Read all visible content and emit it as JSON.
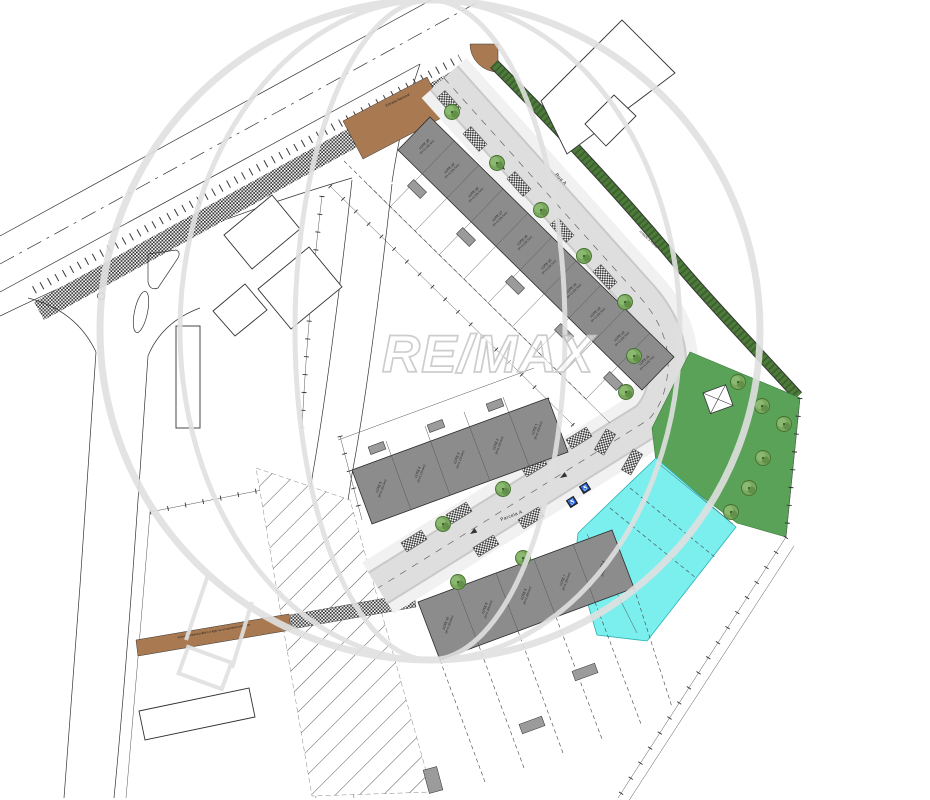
{
  "watermark": {
    "text": "RE/MAX"
  },
  "streets": {
    "main_road_label": "Estrada Nacional",
    "rua_label": "Rua A",
    "parcela_label": "Parcela A"
  },
  "annotations": {
    "hedge_label": "vedação a manter",
    "path_label": "acesso pedonal público a ligar ao arruamento existente"
  },
  "icons": {
    "tree_icon": "deciduous-tree",
    "wheelchair_glyph": "♿",
    "transformer_icon": "crossed-box"
  },
  "lots": {
    "upper": [
      {
        "name": "LOTE 20",
        "info": "2P+S 238.4m2"
      },
      {
        "name": "LOTE 19",
        "info": "2P+S 206.5m2"
      },
      {
        "name": "LOTE 18",
        "info": "2P+S 206.5m2"
      },
      {
        "name": "LOTE 17",
        "info": "2P+S 206.5m2"
      },
      {
        "name": "LOTE 16",
        "info": "2P+S 206.5m2"
      },
      {
        "name": "LOTE 15",
        "info": "2P+S 206.5m2"
      },
      {
        "name": "LOTE 14",
        "info": "2P+S 206.5m2"
      },
      {
        "name": "LOTE 13",
        "info": "2P+S 206.5m2"
      },
      {
        "name": "LOTE 12",
        "info": "2P+S 206.5m2"
      },
      {
        "name": "LOTE 11",
        "info": "2P+S 228.7m2"
      }
    ],
    "middle": [
      {
        "name": "LOTE 5",
        "info": "2P+S 264.3m2"
      },
      {
        "name": "LOTE 4",
        "info": "2P+S 215.9m2"
      },
      {
        "name": "LOTE 3",
        "info": "2P+S 215.9m2"
      },
      {
        "name": "LOTE 2",
        "info": "2P+S 215.9m2"
      },
      {
        "name": "LOTE 1",
        "info": "2P+S 258.6m2"
      }
    ],
    "lower": [
      {
        "name": "LOTE 10",
        "info": "2P+S 403.8m2"
      },
      {
        "name": "LOTE 9",
        "info": "2P+S 296.5m2"
      },
      {
        "name": "LOTE 8",
        "info": "2P+S 296.5m2"
      },
      {
        "name": "LOTE 7",
        "info": "2P+S 296.5m2"
      },
      {
        "name": "LOTE 6",
        "info": "2P+S 303.8m2"
      }
    ]
  },
  "colors": {
    "road_asphalt": "#dedede",
    "building": "#8c8c8c",
    "annex": "#9b9b9b",
    "lawn": "#59a257",
    "pool": "#7beeee",
    "hedge": "#4e7b3c",
    "path_brown": "#a97a52",
    "watermark": "#d8d8d8"
  }
}
